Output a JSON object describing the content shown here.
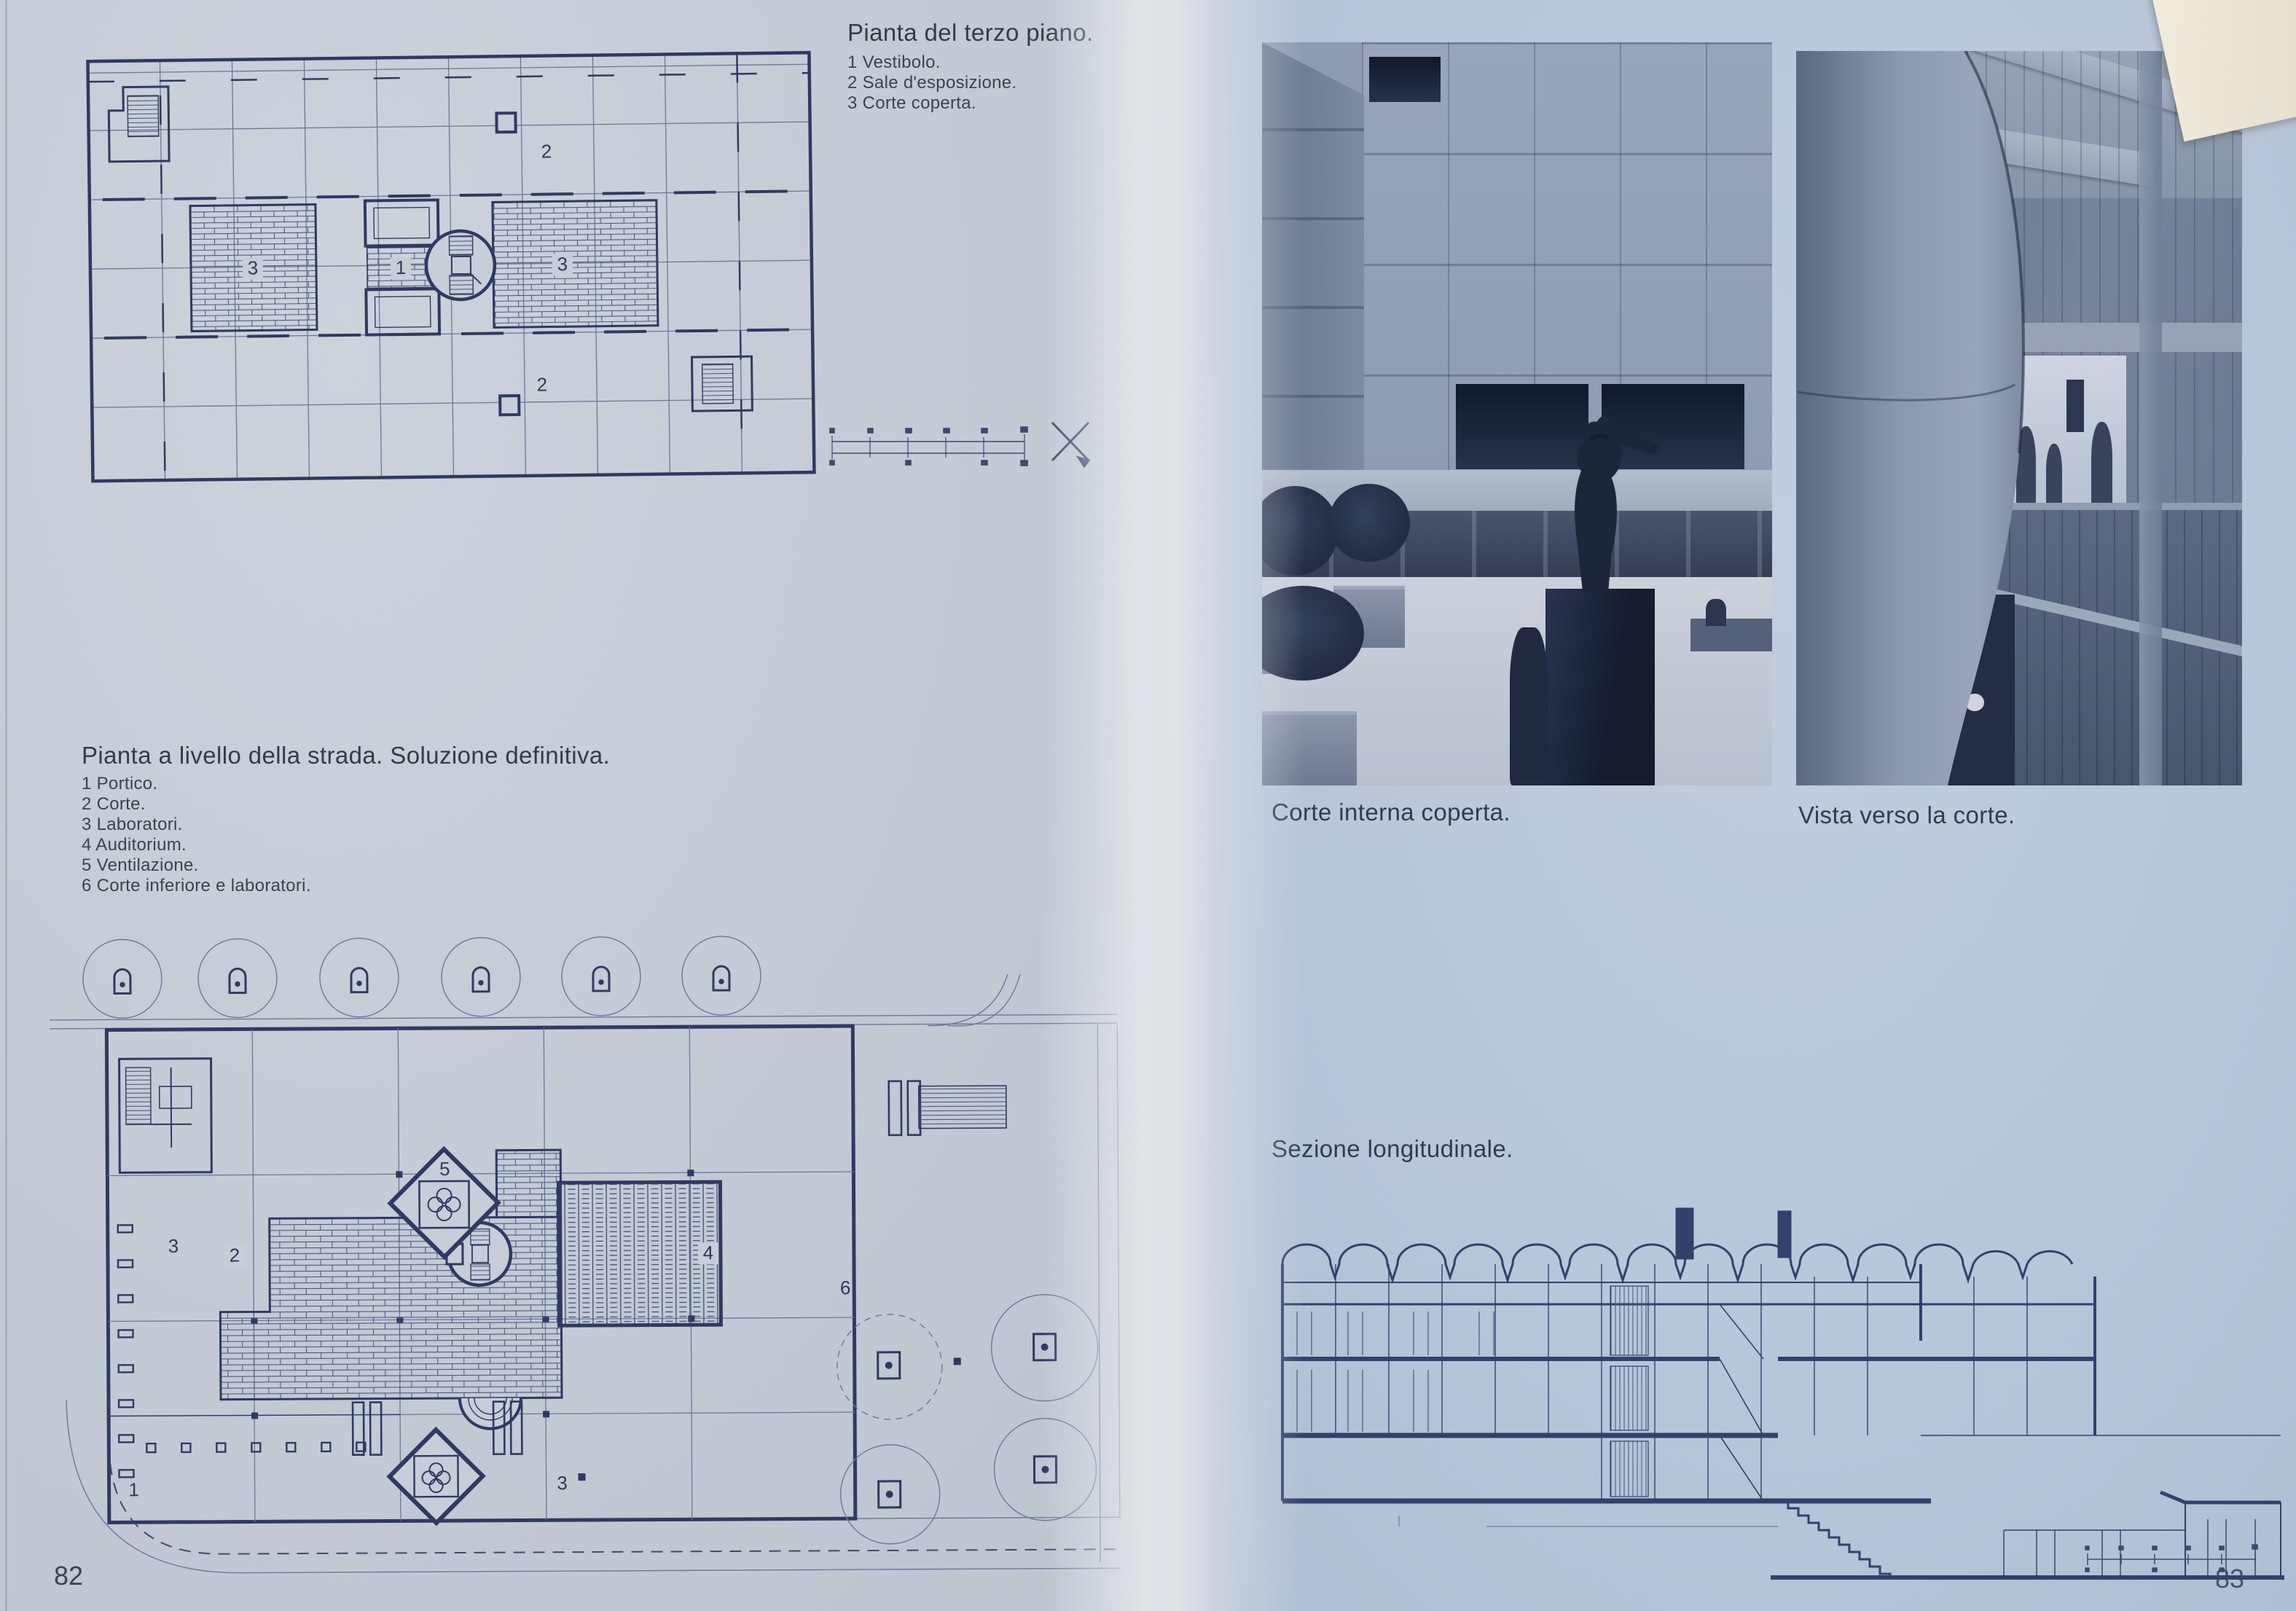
{
  "book": {
    "page_left": {
      "page_number": "82",
      "plan_third_floor": {
        "title": "Pianta del terzo piano.",
        "legend": [
          "1 Vestibolo.",
          "2 Sale d'esposizione.",
          "3 Corte coperta."
        ],
        "labels": {
          "vestibolo": "1",
          "sale": "2",
          "corte": "3"
        }
      },
      "plan_street_level": {
        "title": "Pianta a livello della strada. Soluzione definitiva.",
        "legend": [
          "1 Portico.",
          "2 Corte.",
          "3 Laboratori.",
          "4 Auditorium.",
          "5 Ventilazione.",
          "6 Corte inferiore e laboratori."
        ],
        "labels": {
          "portico": "1",
          "corte": "2",
          "laboratori": "3",
          "auditorium": "4",
          "ventilazione": "5",
          "corte_inferiore": "6"
        }
      }
    },
    "page_right": {
      "page_number": "83",
      "captions": {
        "photo_left": "Corte interna coperta.",
        "photo_right": "Vista verso la corte.",
        "section": "Sezione longitudinale."
      }
    },
    "colors": {
      "page_left_bg": "#c5ccd6",
      "page_right_bg": "#b9c6da",
      "ink": "#2f3a58",
      "photo_shadow": "#1c2435",
      "flap": "#e9e2d0"
    }
  }
}
